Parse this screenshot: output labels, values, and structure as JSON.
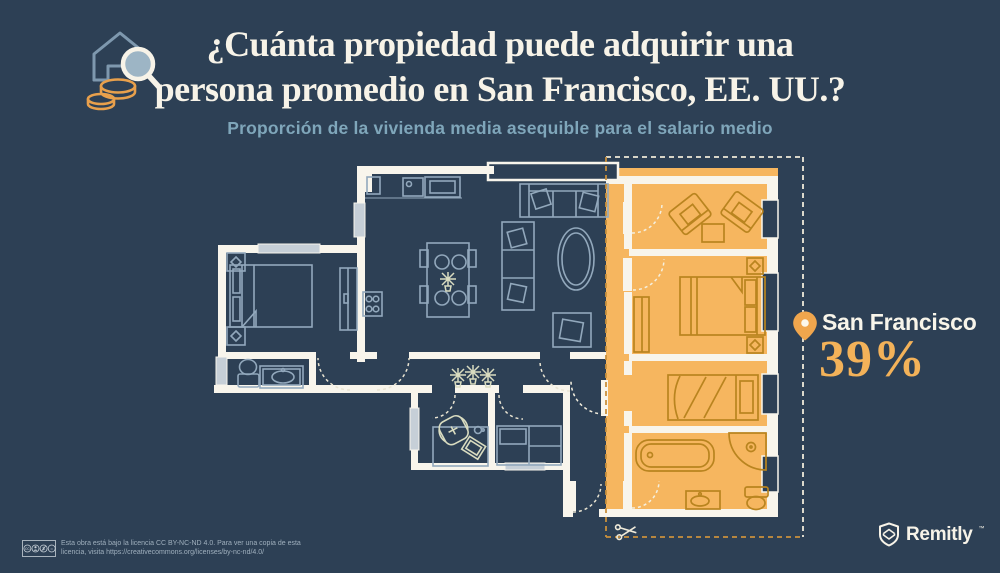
{
  "header": {
    "title_line1": "¿Cuánta propiedad puede adquirir una",
    "title_line2": "persona promedio en San Francisco, EE. UU.?",
    "subtitle": "Proporción de la vivienda media asequible para el salario medio"
  },
  "callout": {
    "city": "San Francisco",
    "value": "39%",
    "affordability_percent": 39
  },
  "footer": {
    "license_line1": "Esta obra está bajo la licencia CC BY-NC-ND 4.0. Para ver una copia de esta",
    "license_line2": "licencia, visita https://creativecommons.org/licenses/by-nc-nd/4.0/",
    "brand": "Remitly",
    "trademark": "™"
  },
  "colors": {
    "background": "#2D4055",
    "wall": "#F8F5EC",
    "furniture_line": "#92A8BC",
    "plant_line": "#D9DCC0",
    "highlight_fill": "#F6B65F",
    "highlight_furniture_line": "#B9841F",
    "cut_dash_line": "#C9903C",
    "border_dash_line": "#EFEAD9",
    "accent_text": "#F3B259",
    "subtitle_text": "#7FA6BA",
    "title_text": "#F7F3E8",
    "pin": "#F0A64D"
  }
}
